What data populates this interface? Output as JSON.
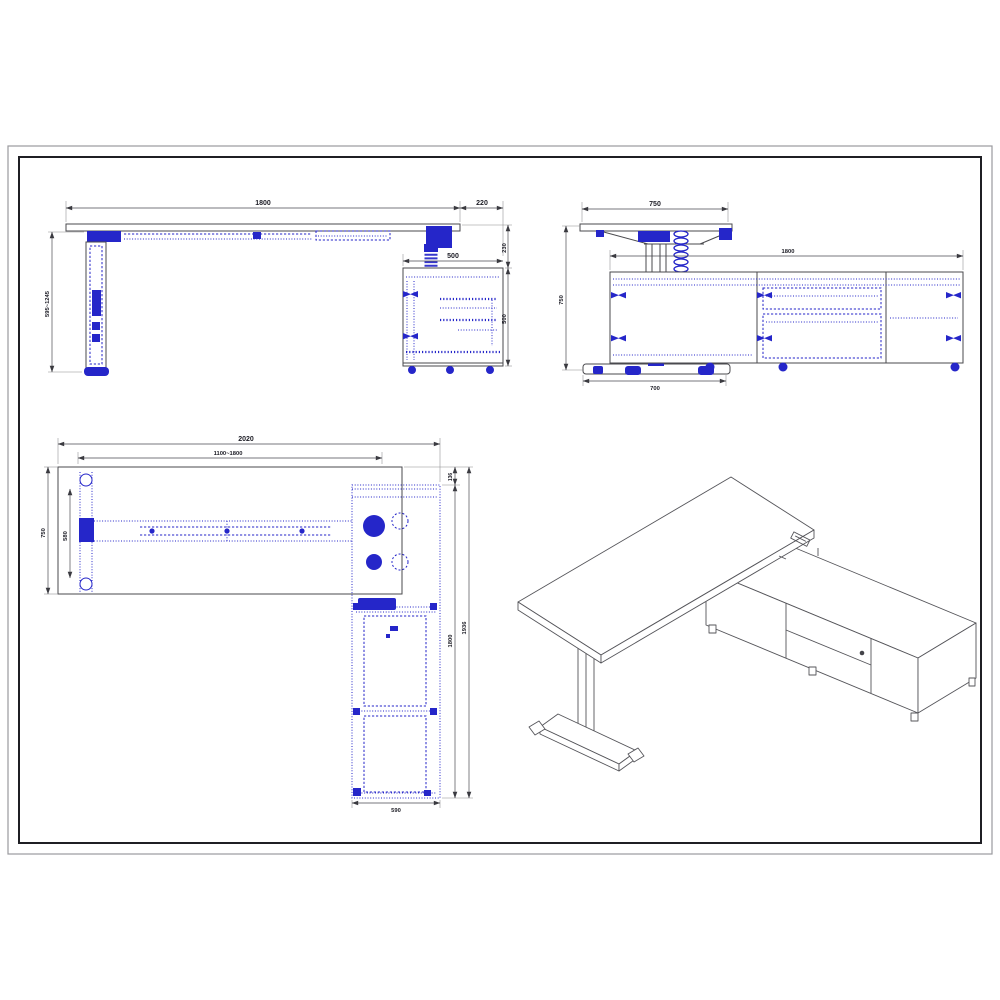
{
  "drawing": {
    "type": "technical-drawing",
    "subject": "height-adjustable L-shaped desk with return cabinet",
    "colors": {
      "blueprint_blue": "#2526c9",
      "outline_gray": "#4a4a4e",
      "dim_text": "#1b1b24",
      "frame_black": "#1f1f24"
    },
    "views": {
      "front": {
        "dims": {
          "desk_width": "1800",
          "overhang": "220",
          "cabinet_width": "500",
          "height_range": "595~1245",
          "desk_to_cabinet_gap": "230",
          "cabinet_height": "500"
        }
      },
      "side": {
        "dims": {
          "desk_depth": "750",
          "cabinet_length": "1800",
          "desk_height": "750",
          "foot_length": "700"
        }
      },
      "plan": {
        "dims": {
          "overall_length": "2020",
          "adjustable_range": "1100~1800",
          "desk_depth": "750",
          "foot_span": "580",
          "corner_offset": "136",
          "cabinet_run": "1800",
          "overall_depth": "1936",
          "cabinet_width": "590"
        }
      }
    }
  }
}
